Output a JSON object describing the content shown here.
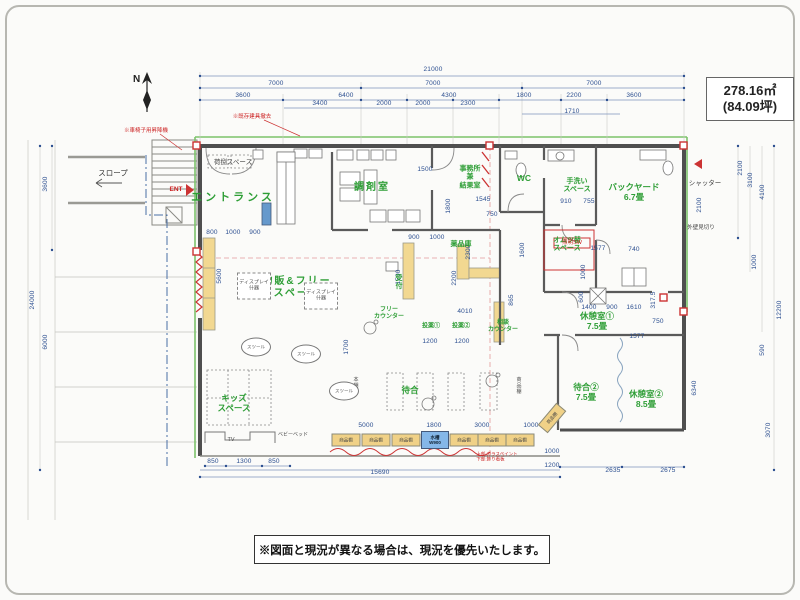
{
  "header": {
    "area_m2": "278.16㎡",
    "area_tsubo": "(84.09坪)"
  },
  "footer": {
    "note": "※図面と現況が異なる場合は、現況を優先いたします。"
  },
  "compass": {
    "label": "N"
  },
  "colors": {
    "dimension": "#2a4d8f",
    "room_label": "#2e9e36",
    "wall": "#4f4f4f",
    "boundary_line": "#7cc36b",
    "accent_red": "#cc3333",
    "shelf_fill": "#f0d187",
    "tank_fill": "#85b7e8"
  },
  "texts": [
    {
      "t": "21000",
      "x": 433,
      "y": 70
    },
    {
      "t": "7000",
      "x": 276,
      "y": 84
    },
    {
      "t": "7000",
      "x": 433,
      "y": 84
    },
    {
      "t": "7000",
      "x": 594,
      "y": 84
    },
    {
      "t": "3600",
      "x": 243,
      "y": 96
    },
    {
      "t": "6400",
      "x": 346,
      "y": 96
    },
    {
      "t": "4300",
      "x": 449,
      "y": 96
    },
    {
      "t": "1800",
      "x": 524,
      "y": 96
    },
    {
      "t": "2200",
      "x": 574,
      "y": 96
    },
    {
      "t": "3600",
      "x": 634,
      "y": 96
    },
    {
      "t": "3400",
      "x": 320,
      "y": 104
    },
    {
      "t": "2000",
      "x": 384,
      "y": 104
    },
    {
      "t": "2000",
      "x": 423,
      "y": 104
    },
    {
      "t": "2300",
      "x": 468,
      "y": 104
    },
    {
      "t": "1710",
      "x": 572,
      "y": 112
    },
    {
      "t": "3600",
      "x": 46,
      "y": 184,
      "r": -90
    },
    {
      "t": "6000",
      "x": 46,
      "y": 342,
      "r": -90
    },
    {
      "t": "24000",
      "x": 33,
      "y": 300,
      "r": -90
    },
    {
      "t": "2100",
      "x": 741,
      "y": 168,
      "r": -90
    },
    {
      "t": "3100",
      "x": 751,
      "y": 180,
      "r": -90
    },
    {
      "t": "4100",
      "x": 763,
      "y": 192,
      "r": -90
    },
    {
      "t": "2100",
      "x": 700,
      "y": 205,
      "r": -90
    },
    {
      "t": "1000",
      "x": 755,
      "y": 262,
      "r": -90
    },
    {
      "t": "590",
      "x": 763,
      "y": 350,
      "r": -90
    },
    {
      "t": "6340",
      "x": 695,
      "y": 388,
      "r": -90
    },
    {
      "t": "3070",
      "x": 769,
      "y": 430,
      "r": -90
    },
    {
      "t": "12200",
      "x": 780,
      "y": 310,
      "r": -90
    },
    {
      "t": "850",
      "x": 213,
      "y": 462
    },
    {
      "t": "1300",
      "x": 244,
      "y": 462
    },
    {
      "t": "850",
      "x": 274,
      "y": 462
    },
    {
      "t": "5000",
      "x": 366,
      "y": 426
    },
    {
      "t": "1800",
      "x": 434,
      "y": 426
    },
    {
      "t": "3000",
      "x": 482,
      "y": 426
    },
    {
      "t": "1000",
      "x": 531,
      "y": 426
    },
    {
      "t": "15690",
      "x": 380,
      "y": 473
    },
    {
      "t": "1000",
      "x": 552,
      "y": 452
    },
    {
      "t": "1200",
      "x": 552,
      "y": 466
    },
    {
      "t": "2635",
      "x": 613,
      "y": 471
    },
    {
      "t": "2675",
      "x": 668,
      "y": 471
    },
    {
      "t": "1500",
      "x": 425,
      "y": 170
    },
    {
      "t": "1545",
      "x": 483,
      "y": 200
    },
    {
      "t": "1800",
      "x": 449,
      "y": 206,
      "r": -90
    },
    {
      "t": "900",
      "x": 414,
      "y": 238
    },
    {
      "t": "1000",
      "x": 437,
      "y": 238
    },
    {
      "t": "750",
      "x": 492,
      "y": 215
    },
    {
      "t": "2300",
      "x": 469,
      "y": 252,
      "r": -90
    },
    {
      "t": "2200",
      "x": 455,
      "y": 278,
      "r": -90
    },
    {
      "t": "1600",
      "x": 523,
      "y": 250,
      "r": -90
    },
    {
      "t": "1500",
      "x": 399,
      "y": 277,
      "r": -90
    },
    {
      "t": "865",
      "x": 512,
      "y": 300,
      "r": -90
    },
    {
      "t": "4010",
      "x": 465,
      "y": 312
    },
    {
      "t": "1200",
      "x": 430,
      "y": 342
    },
    {
      "t": "1200",
      "x": 462,
      "y": 342
    },
    {
      "t": "1577",
      "x": 598,
      "y": 249
    },
    {
      "t": "740",
      "x": 634,
      "y": 250
    },
    {
      "t": "1000",
      "x": 584,
      "y": 272,
      "r": -90
    },
    {
      "t": "600",
      "x": 582,
      "y": 297,
      "r": -90
    },
    {
      "t": "1400",
      "x": 589,
      "y": 308
    },
    {
      "t": "900",
      "x": 612,
      "y": 308
    },
    {
      "t": "1610",
      "x": 634,
      "y": 308
    },
    {
      "t": "317.5",
      "x": 654,
      "y": 300,
      "r": -90
    },
    {
      "t": "750",
      "x": 658,
      "y": 322
    },
    {
      "t": "1577",
      "x": 637,
      "y": 337
    },
    {
      "t": "910",
      "x": 566,
      "y": 202
    },
    {
      "t": "755",
      "x": 589,
      "y": 202
    },
    {
      "t": "5600",
      "x": 220,
      "y": 276,
      "r": -90
    },
    {
      "t": "1700",
      "x": 347,
      "y": 347,
      "r": -90
    },
    {
      "t": "800",
      "x": 212,
      "y": 233
    },
    {
      "t": "1000",
      "x": 233,
      "y": 233
    },
    {
      "t": "900",
      "x": 255,
      "y": 233
    },
    {
      "t": "荷捌スペース",
      "x": 233,
      "y": 163,
      "c": "blk6",
      "n": "room-label-nisabaki-space"
    },
    {
      "t": "エントランス",
      "x": 233,
      "y": 198,
      "c": "gL",
      "n": "room-label-entrance"
    },
    {
      "t": "調剤室",
      "x": 372,
      "y": 188,
      "c": "gM",
      "n": "room-label-dispensary"
    },
    {
      "t": "事務所\n兼\n結果室",
      "x": 470,
      "y": 178,
      "c": "g7",
      "n": "room-label-office"
    },
    {
      "t": "WC",
      "x": 524,
      "y": 178,
      "c": "g8",
      "n": "room-label-wc"
    },
    {
      "t": "手洗い\nスペース",
      "x": 577,
      "y": 186,
      "c": "g7",
      "n": "room-label-handwash"
    },
    {
      "t": "バックヤード\n6.7畳",
      "x": 634,
      "y": 192,
      "c": "g8",
      "n": "room-label-backyard"
    },
    {
      "t": "オムツ替\nスペース",
      "x": 567,
      "y": 245,
      "c": "g7",
      "n": "room-label-diaper-space"
    },
    {
      "t": "薬品庫",
      "x": 461,
      "y": 245,
      "c": "g7",
      "n": "room-label-medicine-storage"
    },
    {
      "t": "受\n付",
      "x": 399,
      "y": 283,
      "c": "g7",
      "n": "room-label-reception"
    },
    {
      "t": "フリー\nカウンター",
      "x": 389,
      "y": 314,
      "c": "g6",
      "n": "room-label-free-counter"
    },
    {
      "t": "投薬①",
      "x": 431,
      "y": 327,
      "c": "g6",
      "n": "room-label-toyaku1"
    },
    {
      "t": "投薬②",
      "x": 461,
      "y": 327,
      "c": "g6",
      "n": "room-label-toyaku2"
    },
    {
      "t": "相談\nカウンター",
      "x": 503,
      "y": 327,
      "c": "g6",
      "n": "room-label-soudan-counter"
    },
    {
      "t": "物販&フリー\nスペース",
      "x": 297,
      "y": 288,
      "c": "gM",
      "n": "room-label-retail-free-space"
    },
    {
      "t": "休憩室①\n7.5畳",
      "x": 597,
      "y": 321,
      "c": "g8",
      "n": "room-label-rest1"
    },
    {
      "t": "待合②\n7.5畳",
      "x": 586,
      "y": 392,
      "c": "g8",
      "n": "room-label-waiting2"
    },
    {
      "t": "休憩室②\n8.5畳",
      "x": 646,
      "y": 399,
      "c": "g8",
      "n": "room-label-rest2"
    },
    {
      "t": "キッズ\nスペース",
      "x": 234,
      "y": 403,
      "c": "g8",
      "n": "room-label-kids-space"
    },
    {
      "t": "待合",
      "x": 410,
      "y": 390,
      "c": "g8",
      "n": "room-label-waiting"
    },
    {
      "t": "スロープ",
      "x": 113,
      "y": 174,
      "c": "blk7",
      "n": "label-slope"
    },
    {
      "t": "TV",
      "x": 231,
      "y": 440,
      "c": "blk5",
      "n": "label-tv"
    },
    {
      "t": "ベビーベッド",
      "x": 293,
      "y": 436,
      "c": "blk4",
      "n": "label-babybed"
    },
    {
      "t": "本\n棚",
      "x": 356,
      "y": 384,
      "c": "blk4",
      "n": "label-bookshelf"
    },
    {
      "t": "商\n品\n棚",
      "x": 519,
      "y": 387,
      "c": "blk4",
      "n": "label-goods-shelf"
    },
    {
      "t": "シャッター",
      "x": 705,
      "y": 184,
      "c": "blk6",
      "n": "label-shutter"
    },
    {
      "t": "外壁見切り",
      "x": 701,
      "y": 228,
      "c": "blk5",
      "n": "label-wall-edge"
    },
    {
      "t": "ENT",
      "x": 176,
      "y": 190,
      "c": "red6",
      "n": "label-ent"
    },
    {
      "t": "照明SW",
      "x": 572,
      "y": 243,
      "c": "red5",
      "n": "label-light-switch"
    },
    {
      "t": "※既存建具撤去",
      "x": 252,
      "y": 117,
      "c": "red5",
      "n": "note-existing-fittings"
    },
    {
      "t": "※車椅子用昇降機",
      "x": 146,
      "y": 131,
      "c": "red5",
      "n": "note-wheelchair-lift"
    },
    {
      "t": "上部:ガラスペイント\n下部:飾り看板",
      "x": 497,
      "y": 457,
      "c": "red4",
      "n": "note-glass-paint"
    },
    {
      "t": "商品棚",
      "x": 346,
      "y": 440,
      "c": "shelf",
      "n": "shelf-box"
    },
    {
      "t": "商品棚",
      "x": 376,
      "y": 440,
      "c": "shelf",
      "n": "shelf-box"
    },
    {
      "t": "商品棚",
      "x": 406,
      "y": 440,
      "c": "shelf",
      "n": "shelf-box"
    },
    {
      "t": "商品棚",
      "x": 464,
      "y": 440,
      "c": "shelf",
      "n": "shelf-box"
    },
    {
      "t": "商品棚",
      "x": 492,
      "y": 440,
      "c": "shelf",
      "n": "shelf-box"
    },
    {
      "t": "商品棚",
      "x": 520,
      "y": 440,
      "c": "shelf",
      "n": "shelf-box"
    },
    {
      "t": "商品棚",
      "x": 552,
      "y": 418,
      "c": "shelf",
      "r": -50,
      "n": "shelf-box"
    },
    {
      "t": "水槽\nW900",
      "x": 435,
      "y": 440,
      "c": "tank",
      "n": "label-aquarium"
    },
    {
      "t": "スツール",
      "x": 256,
      "y": 347,
      "c": "stool",
      "n": "stool"
    },
    {
      "t": "スツール",
      "x": 306,
      "y": 354,
      "c": "stool",
      "n": "stool"
    },
    {
      "t": "スツール",
      "x": 344,
      "y": 391,
      "c": "stool",
      "n": "stool"
    },
    {
      "t": "ディスプレイ\n什器",
      "x": 254,
      "y": 286,
      "c": "disp",
      "n": "display-fixture"
    },
    {
      "t": "ディスプレイ\n什器",
      "x": 321,
      "y": 296,
      "c": "disp",
      "n": "display-fixture"
    }
  ]
}
